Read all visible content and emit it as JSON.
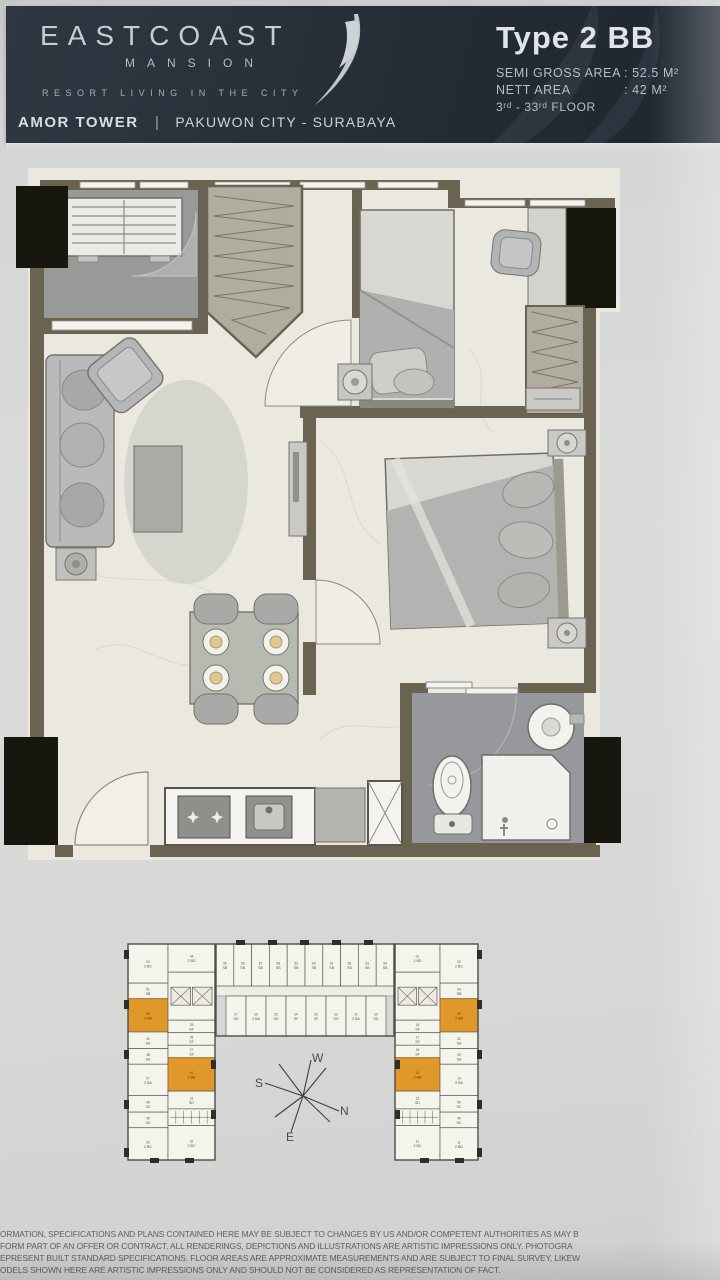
{
  "header": {
    "brand": "EASTCOAST",
    "brand_sub": "MANSION",
    "tagline": "RESORT LIVING IN THE CITY",
    "tower": "AMOR TOWER",
    "divider": "|",
    "location": "PAKUWON CITY - SURABAYA",
    "type_title": "Type 2 BB",
    "specs": [
      {
        "label": "SEMI GROSS AREA",
        "value": ": 52.5 M²"
      },
      {
        "label": "NETT AREA",
        "value": ": 42 M²"
      }
    ],
    "floors": "3ʳᵈ - 33ʳᵈ FLOOR"
  },
  "colors": {
    "header_bg": "#28303a",
    "header_text": "#ccd2d8",
    "paper": "#d8d9d9",
    "plan_paper": "#ebe9df",
    "wall": "#6b6351",
    "black_column": "#17170f",
    "bath_floor": "#97989b",
    "highlight_unit": "#e0982a"
  },
  "compass": {
    "n": "N",
    "s": "S",
    "e": "E",
    "w": "W"
  },
  "floorplate": {
    "highlight_color": "#e0982a",
    "top_row": [
      {
        "no": "55",
        "type": "SB"
      },
      {
        "no": "56",
        "type": "SB"
      },
      {
        "no": "57",
        "type": "SB"
      },
      {
        "no": "58",
        "type": "SB"
      },
      {
        "no": "59",
        "type": "SB"
      },
      {
        "no": "60",
        "type": "SB"
      },
      {
        "no": "61",
        "type": "SB"
      },
      {
        "no": "62",
        "type": "SB"
      },
      {
        "no": "63",
        "type": "SB"
      },
      {
        "no": "64",
        "type": "SB"
      }
    ],
    "mid_row": [
      {
        "no": "27",
        "type": "SD"
      },
      {
        "no": "26",
        "type": "2 BA"
      },
      {
        "no": "25",
        "type": "SH"
      },
      {
        "no": "24",
        "type": "SF"
      },
      {
        "no": "23",
        "type": "SF"
      },
      {
        "no": "22",
        "type": "SH"
      },
      {
        "no": "21",
        "type": "2 BA"
      },
      {
        "no": "20",
        "type": "SD"
      }
    ],
    "left_wing_outer": [
      {
        "no": "03",
        "type": "2 BC",
        "h": 40
      },
      {
        "no": "51",
        "type": "SB",
        "h": 16
      },
      {
        "no": "05",
        "type": "2 BB",
        "h": 34,
        "hl": true
      },
      {
        "no": "49",
        "type": "SA",
        "h": 17
      },
      {
        "no": "48",
        "type": "SA",
        "h": 16
      },
      {
        "no": "07",
        "type": "2 BA",
        "h": 32
      },
      {
        "no": "46",
        "type": "SC",
        "h": 17
      },
      {
        "no": "45",
        "type": "SC",
        "h": 16
      },
      {
        "no": "33",
        "type": "2 BC",
        "h": 33
      }
    ],
    "left_wing_inner": [
      {
        "no": "04",
        "type": "2 BD",
        "h": 27
      },
      {
        "type": "",
        "lift": true,
        "h": 46
      },
      {
        "no": "29",
        "type": "SF",
        "h": 12
      },
      {
        "no": "28",
        "type": "SF",
        "h": 12
      },
      {
        "no": "27",
        "type": "SF",
        "h": 12
      },
      {
        "no": "10",
        "type": "2 BB",
        "h": 32,
        "hl": true
      },
      {
        "no": "31",
        "type": "SD",
        "h": 17
      },
      {
        "type": "",
        "stair": true,
        "h": 16
      },
      {
        "no": "32",
        "type": "2 BC",
        "h": 33
      }
    ],
    "right_wing_inner": [
      {
        "no": "01",
        "type": "2 BD",
        "h": 27
      },
      {
        "type": "",
        "lift": true,
        "h": 46
      },
      {
        "no": "18",
        "type": "SF",
        "h": 12
      },
      {
        "no": "17",
        "type": "SF",
        "h": 12
      },
      {
        "no": "16",
        "type": "SF",
        "h": 12
      },
      {
        "no": "10",
        "type": "2 BB",
        "h": 32,
        "hl": true
      },
      {
        "no": "15",
        "type": "SD",
        "h": 17
      },
      {
        "type": "",
        "stair": true,
        "h": 16
      },
      {
        "no": "12",
        "type": "2 BC",
        "h": 33
      }
    ],
    "right_wing_outer": [
      {
        "no": "02",
        "type": "2 BC",
        "h": 40
      },
      {
        "no": "54",
        "type": "SB",
        "h": 16
      },
      {
        "no": "05",
        "type": "2 BB",
        "h": 34,
        "hl": true
      },
      {
        "no": "52",
        "type": "SA",
        "h": 17
      },
      {
        "no": "53",
        "type": "SA",
        "h": 16
      },
      {
        "no": "14",
        "type": "2 BA",
        "h": 32
      },
      {
        "no": "50",
        "type": "SC",
        "h": 17
      },
      {
        "no": "49",
        "type": "SC",
        "h": 16
      },
      {
        "no": "11",
        "type": "2 BD",
        "h": 33
      }
    ]
  },
  "disclaimer": {
    "lines": [
      "ORMATION, SPECIFICATIONS AND PLANS CONTAINED HERE MAY BE SUBJECT TO CHANGES BY US AND/OR COMPETENT AUTHORITIES AS MAY B",
      "FORM PART OF AN OFFER OR CONTRACT. ALL RENDERINGS, DEPICTIONS AND ILLUSTRATIONS ARE ARTISTIC IMPRESSIONS ONLY. PHOTOGRA",
      "EPRESENT BUILT STANDARD SPECIFICATIONS. FLOOR AREAS ARE APPROXIMATE MEASUREMENTS AND ARE SUBJECT TO FINAL SURVEY, LIKEW",
      "ODELS SHOWN HERE ARE ARTISTIC IMPRESSIONS ONLY AND SHOULD NOT BE CONSIDERED AS REPRESENTATION OF FACT."
    ]
  }
}
